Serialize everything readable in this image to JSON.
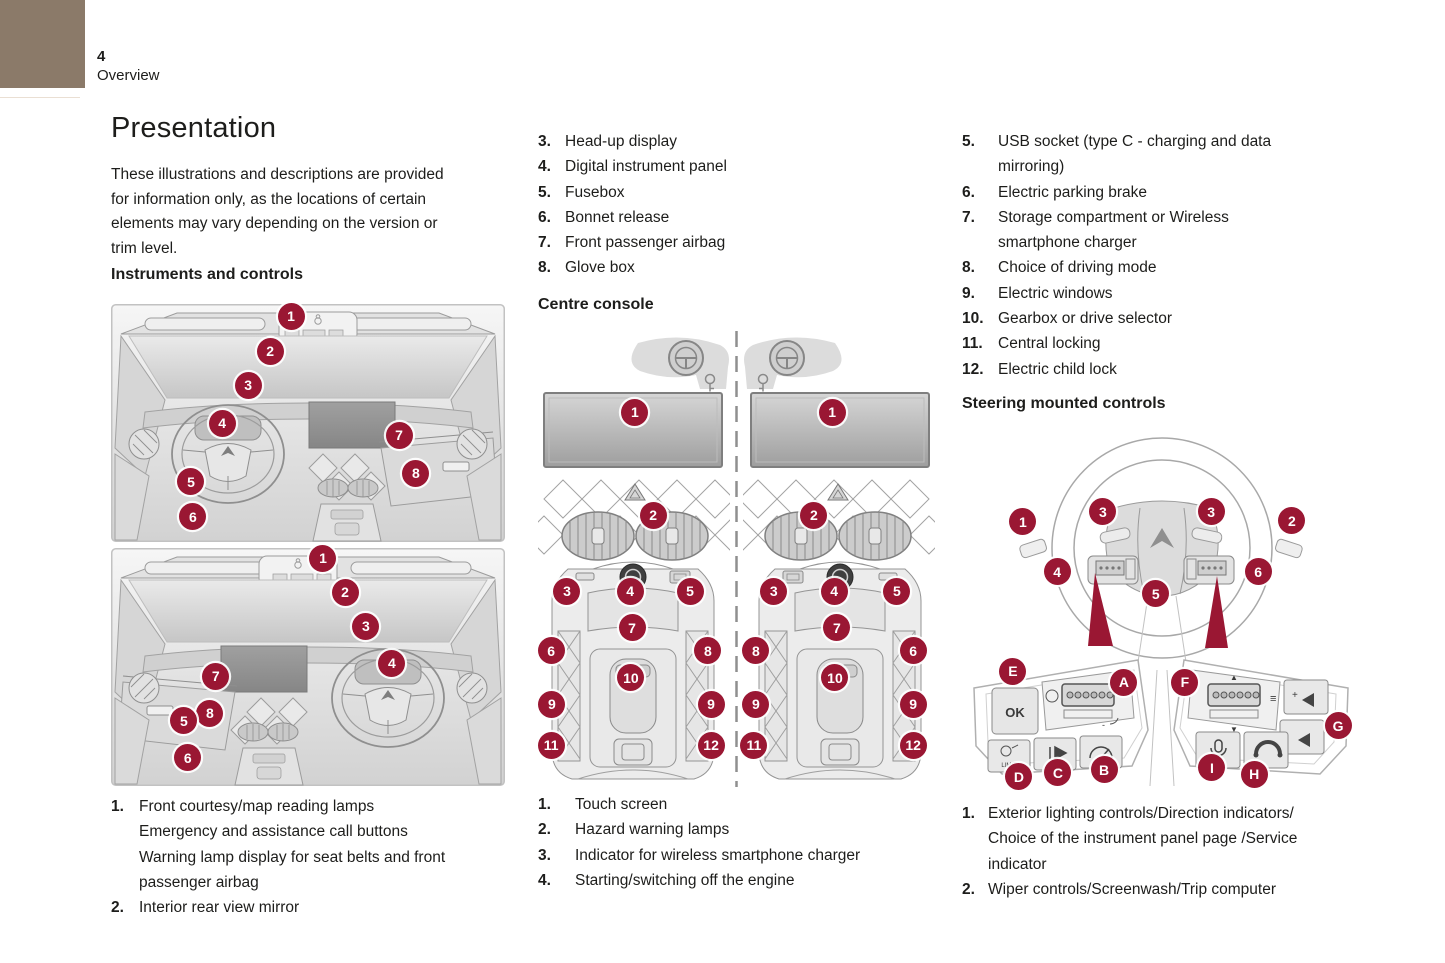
{
  "header": {
    "page_number": "4",
    "section": "Overview"
  },
  "title": "Presentation",
  "intro": "These illustrations and descriptions are provided\nfor information only, as the locations of certain\nelements may vary depending on the version or\ntrim level.",
  "colors": {
    "accent": "#9a1733",
    "corner_block": "#8b7a69"
  },
  "instruments": {
    "heading": "Instruments and controls",
    "figure": {
      "callouts": [
        {
          "label": "1",
          "x": 45.7,
          "y": 2.9
        },
        {
          "label": "2",
          "x": 40.4,
          "y": 10.1
        },
        {
          "label": "3",
          "x": 34.8,
          "y": 17.1
        },
        {
          "label": "4",
          "x": 28.2,
          "y": 24.9
        },
        {
          "label": "7",
          "x": 73.1,
          "y": 27.4
        },
        {
          "label": "8",
          "x": 77.4,
          "y": 35.2
        },
        {
          "label": "5",
          "x": 20.3,
          "y": 37.0
        },
        {
          "label": "6",
          "x": 20.8,
          "y": 44.2
        },
        {
          "label": "1",
          "x": 53.8,
          "y": 52.7
        },
        {
          "label": "2",
          "x": 59.4,
          "y": 59.7
        },
        {
          "label": "3",
          "x": 64.7,
          "y": 66.7
        },
        {
          "label": "4",
          "x": 71.3,
          "y": 74.3
        },
        {
          "label": "7",
          "x": 26.6,
          "y": 77.0
        },
        {
          "label": "8",
          "x": 25.1,
          "y": 84.6
        },
        {
          "label": "5",
          "x": 18.5,
          "y": 86.2
        },
        {
          "label": "6",
          "x": 19.5,
          "y": 93.8
        }
      ]
    },
    "legend_a": [
      {
        "num": "1.",
        "text": "Front courtesy/map reading lamps\nEmergency and assistance call buttons\nWarning lamp display for seat belts and front\npassenger airbag"
      },
      {
        "num": "2.",
        "text": "Interior rear view mirror"
      }
    ],
    "legend_b": [
      {
        "num": "3.",
        "text": "Head-up display"
      },
      {
        "num": "4.",
        "text": "Digital instrument panel"
      },
      {
        "num": "5.",
        "text": "Fusebox"
      },
      {
        "num": "6.",
        "text": "Bonnet release"
      },
      {
        "num": "7.",
        "text": "Front passenger airbag"
      },
      {
        "num": "8.",
        "text": "Glove box"
      }
    ]
  },
  "console": {
    "heading": "Centre console",
    "figure": {
      "callouts": [
        {
          "label": "1",
          "x": 24.4,
          "y": 17.8
        },
        {
          "label": "2",
          "x": 29.0,
          "y": 40.4
        },
        {
          "label": "3",
          "x": 7.3,
          "y": 57.1
        },
        {
          "label": "4",
          "x": 23.2,
          "y": 57.1
        },
        {
          "label": "5",
          "x": 38.3,
          "y": 57.1
        },
        {
          "label": "7",
          "x": 23.7,
          "y": 65.1
        },
        {
          "label": "6",
          "x": 3.3,
          "y": 70.1
        },
        {
          "label": "8",
          "x": 42.8,
          "y": 70.1
        },
        {
          "label": "10",
          "x": 23.4,
          "y": 76.0
        },
        {
          "label": "9",
          "x": 3.5,
          "y": 81.8
        },
        {
          "label": "9",
          "x": 43.6,
          "y": 81.8
        },
        {
          "label": "11",
          "x": 3.3,
          "y": 90.8
        },
        {
          "label": "12",
          "x": 43.6,
          "y": 90.8
        },
        {
          "label": "1",
          "x": 74.1,
          "y": 17.8
        },
        {
          "label": "2",
          "x": 69.5,
          "y": 40.4
        },
        {
          "label": "3",
          "x": 59.4,
          "y": 57.1
        },
        {
          "label": "4",
          "x": 74.6,
          "y": 57.1
        },
        {
          "label": "5",
          "x": 90.4,
          "y": 57.1
        },
        {
          "label": "7",
          "x": 75.3,
          "y": 65.1
        },
        {
          "label": "8",
          "x": 54.9,
          "y": 70.1
        },
        {
          "label": "6",
          "x": 94.5,
          "y": 70.1
        },
        {
          "label": "10",
          "x": 74.8,
          "y": 76.0
        },
        {
          "label": "9",
          "x": 54.9,
          "y": 81.8
        },
        {
          "label": "9",
          "x": 94.5,
          "y": 81.8
        },
        {
          "label": "11",
          "x": 54.4,
          "y": 90.8
        },
        {
          "label": "12",
          "x": 94.5,
          "y": 90.8
        }
      ]
    },
    "legend_a": [
      {
        "num": "1.",
        "text": "Touch screen"
      },
      {
        "num": "2.",
        "text": "Hazard warning lamps"
      },
      {
        "num": "3.",
        "text": "Indicator for wireless smartphone charger"
      },
      {
        "num": "4.",
        "text": "Starting/switching off the engine"
      }
    ],
    "legend_b": [
      {
        "num": "5.",
        "text": "USB socket (type C - charging and data\nmirroring)"
      },
      {
        "num": "6.",
        "text": "Electric parking brake"
      },
      {
        "num": "7.",
        "text": "Storage compartment or Wireless\nsmartphone charger"
      },
      {
        "num": "8.",
        "text": "Choice of driving mode"
      },
      {
        "num": "9.",
        "text": "Electric windows"
      },
      {
        "num": "10.",
        "text": "Gearbox or drive selector"
      },
      {
        "num": "11.",
        "text": "Central locking"
      },
      {
        "num": "12.",
        "text": "Electric child lock"
      }
    ]
  },
  "steering": {
    "heading": "Steering mounted controls",
    "figure": {
      "ok_label": "OK",
      "limit_label": "LIMIT",
      "glyphs": {
        "plus": "+",
        "minus": "-",
        "up": "▲",
        "down": "▼",
        "list": "≡"
      },
      "callouts": [
        {
          "label": "1",
          "x": 15.3,
          "y": 25.6
        },
        {
          "label": "3",
          "x": 35.4,
          "y": 22.8
        },
        {
          "label": "3",
          "x": 62.6,
          "y": 22.8
        },
        {
          "label": "2",
          "x": 82.9,
          "y": 25.3
        },
        {
          "label": "4",
          "x": 23.9,
          "y": 39.6
        },
        {
          "label": "6",
          "x": 74.4,
          "y": 39.6
        },
        {
          "label": "5",
          "x": 48.7,
          "y": 45.8
        },
        {
          "label": "E",
          "x": 12.8,
          "y": 67.4
        },
        {
          "label": "A",
          "x": 40.7,
          "y": 70.5
        },
        {
          "label": "F",
          "x": 56.0,
          "y": 70.5
        },
        {
          "label": "G",
          "x": 94.5,
          "y": 82.6
        },
        {
          "label": "D",
          "x": 14.3,
          "y": 96.9
        },
        {
          "label": "C",
          "x": 24.1,
          "y": 95.8
        },
        {
          "label": "B",
          "x": 35.7,
          "y": 94.9
        },
        {
          "label": "I",
          "x": 62.8,
          "y": 94.4
        },
        {
          "label": "H",
          "x": 73.4,
          "y": 96.1
        }
      ]
    },
    "legend": [
      {
        "num": "1.",
        "text": "Exterior lighting controls/Direction indicators/\nChoice of the instrument panel page /Service\nindicator"
      },
      {
        "num": "2.",
        "text": "Wiper controls/Screenwash/Trip computer"
      }
    ]
  }
}
